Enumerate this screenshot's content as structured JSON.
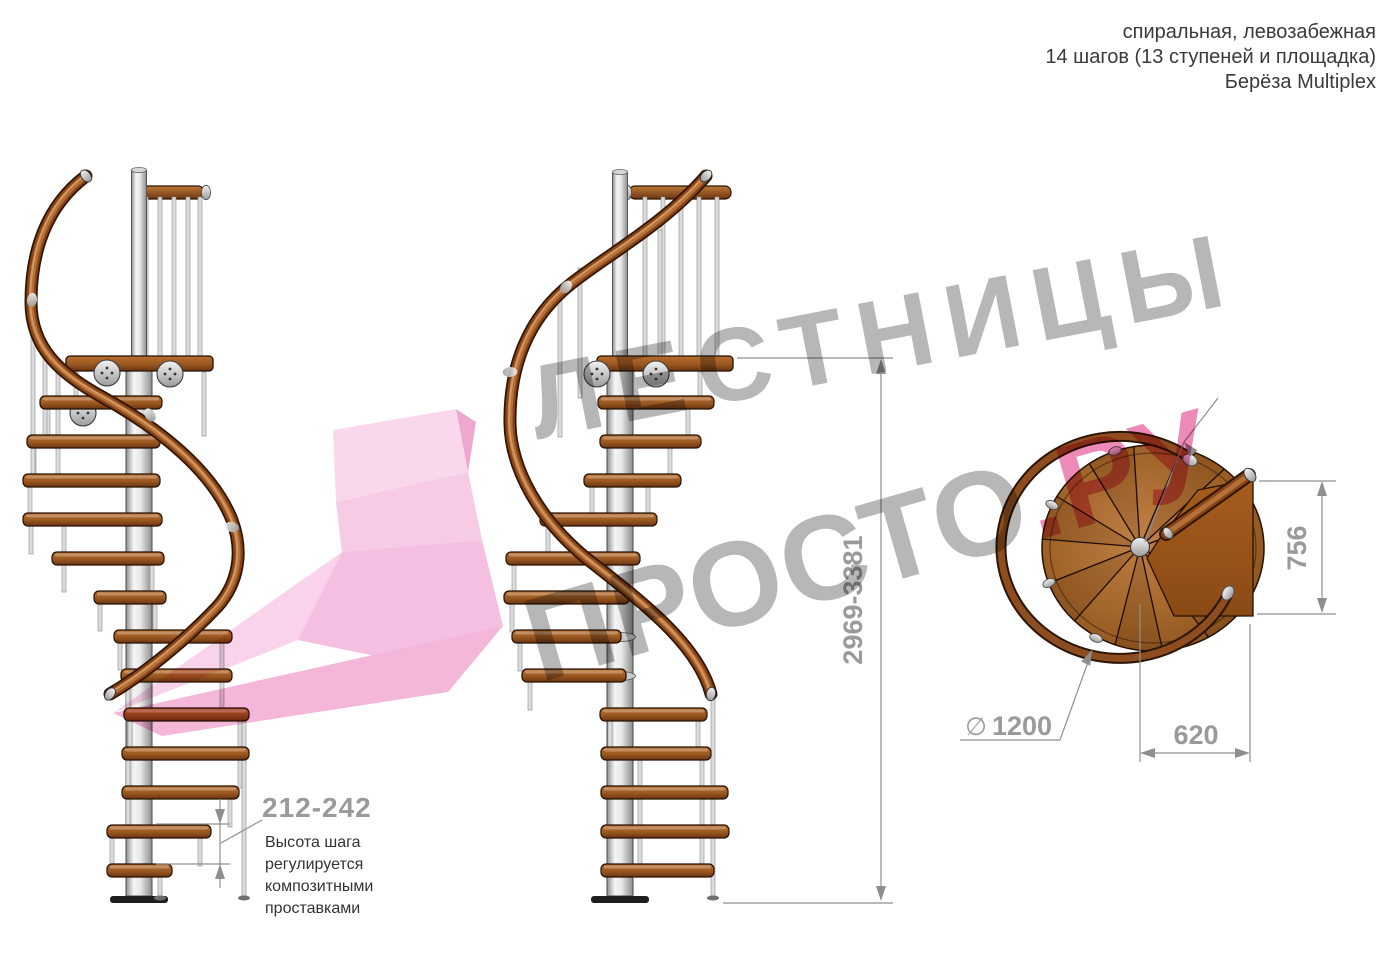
{
  "header": {
    "line1": "спиральная, левозабежная",
    "line2": "14 шагов (13 ступеней и площадка)",
    "line3": "Берёза Multiplex"
  },
  "watermark": {
    "word1": "ЛЕСТНИЦЫ",
    "word2": "ПРОСТО",
    "word3": ".РУ",
    "gray": "#ababab",
    "pink": "#ea75ab",
    "arrow_pink": "#f2aed8"
  },
  "dimensions": {
    "total_height": "2969-3381",
    "step_height": "212-242",
    "diameter_symbol": "∅",
    "diameter_value": "1200",
    "landing_width": "620",
    "landing_depth": "756"
  },
  "note": {
    "lines": [
      "Высота шага",
      "регулируется",
      "композитными",
      "проставками"
    ]
  },
  "colors": {
    "wood": "#a9682f",
    "wood_dark": "#6b3410",
    "steel": "#d9d9d9",
    "dim_gray": "#9a9a9a",
    "text_dark": "#3a3a3a"
  }
}
